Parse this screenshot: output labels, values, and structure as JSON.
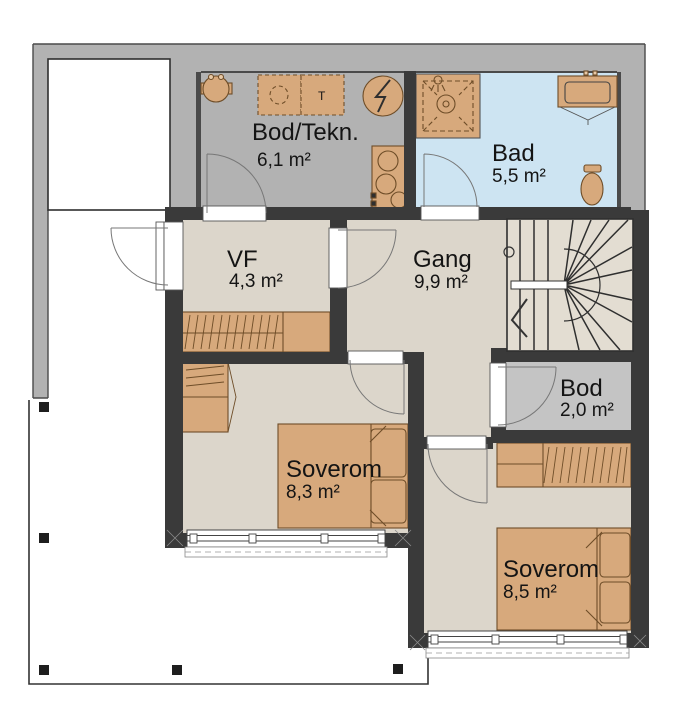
{
  "title": "Floor plan",
  "colors": {
    "wall": "#3a3a3a",
    "cold_zone": "#b2b2b2",
    "floor": "#dcd6cb",
    "stairs_floor": "#e3ddd2",
    "bath_floor": "#cde4f2",
    "storage_floor": "#c4c4c4",
    "furniture": "#d7a97c"
  },
  "rooms": [
    {
      "id": "bod-tekn",
      "name": "Bod/Tekn.",
      "area": "6,1 m²"
    },
    {
      "id": "bad",
      "name": "Bad",
      "area": "5,5 m²"
    },
    {
      "id": "vf",
      "name": "VF",
      "area": "4,3 m²"
    },
    {
      "id": "gang",
      "name": "Gang",
      "area": "9,9 m²"
    },
    {
      "id": "bod",
      "name": "Bod",
      "area": "2,0 m²"
    },
    {
      "id": "soverom-1",
      "name": "Soverom",
      "area": "8,3 m²"
    },
    {
      "id": "soverom-2",
      "name": "Soverom",
      "area": "8,5 m²"
    }
  ],
  "symbols": {
    "dryer_label": "T"
  }
}
